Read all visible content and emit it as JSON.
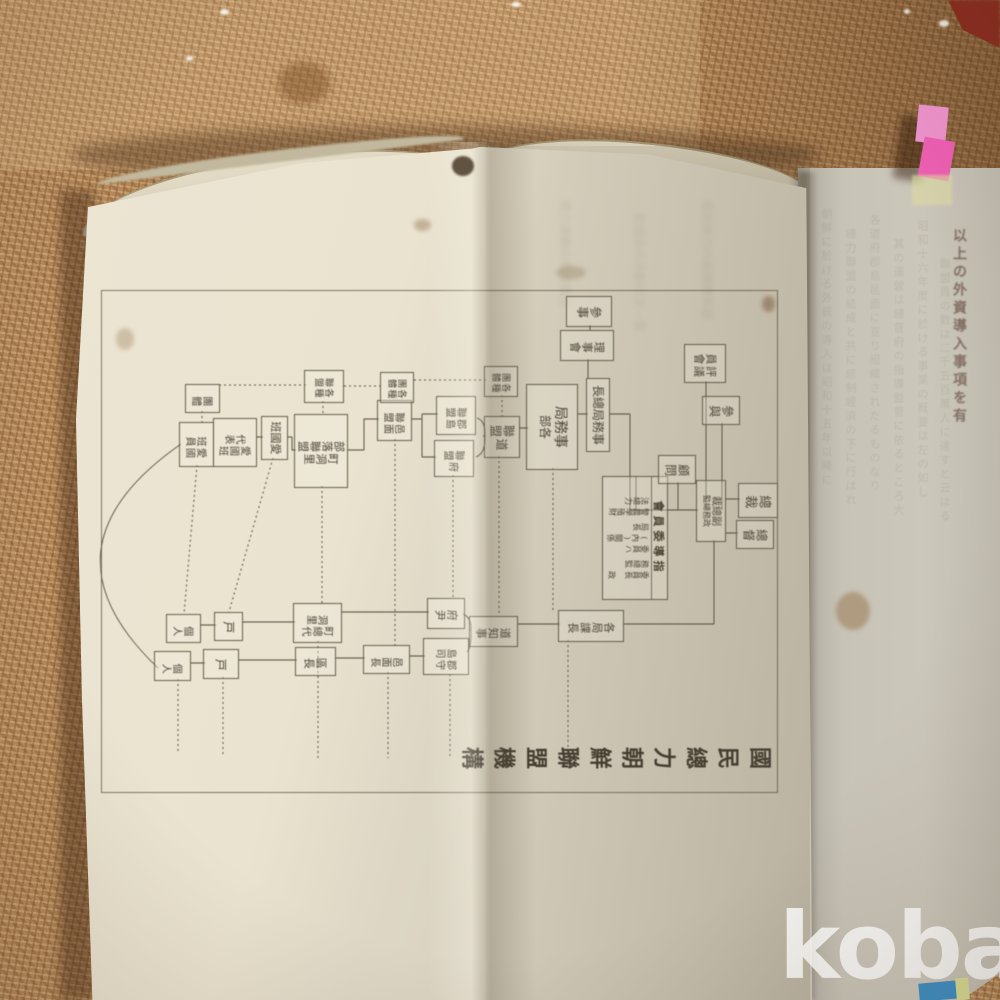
{
  "watermark": "kobay",
  "book": {
    "right_page_text": "以上の外資導入事項を有",
    "ghost_columns": [
      "朝鮮に於ける外資の導入は昭和十五年以降に",
      "總力聯盟の結成と共に統制經濟の下に行はれ",
      "各道府郡島邑面に亘り組織されたるものなり",
      "其の運營は總督府の指導監督に依るところ大",
      "昭和十六年度に於ける事業の概要は左の如し",
      "聯盟員の數は二千五百萬人に達すと云はる"
    ],
    "bleed_texts": [
      "總力運動の實踐要目",
      "愛國班の活動狀況一覽",
      "國民總力の組織體系圖"
    ]
  },
  "chart": {
    "title": "國民總力朝鮮聯盟機構",
    "committee": {
      "header": "指導委員會",
      "columns": [
        "委員長 政務總監",
        "委員ハ(內)關係局長",
        "警農學殖財法總力"
      ]
    },
    "boxes": [
      {
        "id": "sosai",
        "label": "總裁",
        "mode": "v",
        "x": 195,
        "y": 2,
        "w": 33,
        "h": 38,
        "fs": 13
      },
      {
        "id": "sotoku",
        "label": "總督",
        "mode": "v",
        "x": 232,
        "y": 6,
        "w": 27,
        "h": 36,
        "fs": 12
      },
      {
        "id": "fuku-sosai",
        "label": "副總裁",
        "label2": "政務總監",
        "mode": "h2",
        "x": 192,
        "y": 54,
        "w": 60,
        "h": 28,
        "fs": 10
      },
      {
        "id": "sanyo",
        "label": "參與",
        "mode": "v",
        "x": 108,
        "y": 40,
        "w": 27,
        "h": 36,
        "fs": 12
      },
      {
        "id": "hyogiin-kai",
        "label": "評議員會",
        "cols": [
          "評議",
          "員會"
        ],
        "mode": "cols",
        "x": 56,
        "y": 54,
        "w": 37,
        "h": 40,
        "fs": 11
      },
      {
        "id": "komon",
        "label": "顧問",
        "mode": "v",
        "x": 167,
        "y": 84,
        "w": 27,
        "h": 36,
        "fs": 12
      },
      {
        "id": "sanji",
        "label": "參事",
        "mode": "v",
        "x": 8,
        "y": 168,
        "w": 29,
        "h": 44,
        "fs": 12
      },
      {
        "id": "riji-kai",
        "label": "理事會",
        "mode": "v",
        "x": 42,
        "y": 166,
        "w": 29,
        "h": 52,
        "fs": 11
      },
      {
        "id": "jimukyoku-socho",
        "label": "事務局總長",
        "mode": "h",
        "x": 90,
        "y": 170,
        "w": 72,
        "h": 22,
        "fs": 12
      },
      {
        "id": "jimukyoku-kakubu",
        "label": "事務局",
        "label2": "各部",
        "mode": "h2",
        "x": 96,
        "y": 202,
        "w": 84,
        "h": 50,
        "fs": 14
      },
      {
        "id": "do-renmei",
        "label": "道聯盟",
        "cols": [
          "道",
          "聯盟"
        ],
        "mode": "cols",
        "x": 128,
        "y": 260,
        "w": 40,
        "h": 34,
        "fs": 12
      },
      {
        "id": "kakushu-dantai-1",
        "label": "各種團體",
        "cols": [
          "各種",
          "團體"
        ],
        "mode": "cols",
        "x": 78,
        "y": 262,
        "w": 29,
        "h": 32,
        "fs": 9
      },
      {
        "id": "gunto-renmei",
        "label": "郡島聯盟",
        "cols": [
          "郡島",
          "聯盟"
        ],
        "mode": "cols",
        "x": 108,
        "y": 304,
        "w": 37,
        "h": 38,
        "fs": 10
      },
      {
        "id": "fu-renmei",
        "label": "府聯盟",
        "cols": [
          "府",
          "聯盟"
        ],
        "mode": "cols",
        "x": 152,
        "y": 306,
        "w": 35,
        "h": 38,
        "fs": 10
      },
      {
        "id": "yumen-renmei",
        "label": "邑面聯盟",
        "cols": [
          "邑面",
          "聯盟"
        ],
        "mode": "cols",
        "x": 112,
        "y": 368,
        "w": 39,
        "h": 33,
        "fs": 10
      },
      {
        "id": "kakushu-dantai-2",
        "label": "各種團體",
        "cols": [
          "各種",
          "團體"
        ],
        "mode": "cols",
        "x": 84,
        "y": 366,
        "w": 29,
        "h": 32,
        "fs": 9
      },
      {
        "id": "cho-dori-buraku-renmei",
        "label": "町洞里部落聯盟",
        "cols": [
          "町洞里",
          "部落聯盟"
        ],
        "mode": "cols",
        "x": 126,
        "y": 432,
        "w": 72,
        "h": 52,
        "fs": 11
      },
      {
        "id": "kakushu-renmei",
        "label": "各種聯盟",
        "cols": [
          "各種",
          "聯盟"
        ],
        "mode": "cols",
        "x": 82,
        "y": 436,
        "w": 31,
        "h": 38,
        "fs": 9
      },
      {
        "id": "aikoku-han",
        "label": "愛國班",
        "mode": "h",
        "x": 128,
        "y": 492,
        "w": 42,
        "h": 25,
        "fs": 11
      },
      {
        "id": "aikoku-han-daihyo",
        "label": "愛國班代表",
        "cols": [
          "愛國班",
          "代表"
        ],
        "mode": "cols",
        "x": 130,
        "y": 523,
        "w": 47,
        "h": 42,
        "fs": 10
      },
      {
        "id": "aikoku-han-in",
        "label": "愛國班員",
        "cols": [
          "愛國",
          "班員"
        ],
        "mode": "cols",
        "x": 134,
        "y": 566,
        "w": 43,
        "h": 33,
        "fs": 10
      },
      {
        "id": "dantai",
        "label": "團體",
        "mode": "v",
        "x": 96,
        "y": 560,
        "w": 27,
        "h": 33,
        "fs": 10
      },
      {
        "id": "kakkyoku-kacho",
        "label": "各局課長",
        "mode": "v",
        "x": 322,
        "y": 156,
        "w": 30,
        "h": 64,
        "fs": 11
      },
      {
        "id": "do-chiji",
        "label": "道知事",
        "mode": "v",
        "x": 328,
        "y": 262,
        "w": 29,
        "h": 47,
        "fs": 11
      },
      {
        "id": "fuin",
        "label": "府尹",
        "mode": "v",
        "x": 310,
        "y": 315,
        "w": 29,
        "h": 36,
        "fs": 11
      },
      {
        "id": "gunshu-toshi",
        "label": "郡守島司",
        "cols": [
          "郡守",
          "島司"
        ],
        "mode": "cols",
        "x": 350,
        "y": 311,
        "w": 35,
        "h": 44,
        "fs": 10
      },
      {
        "id": "yumen-cho",
        "label": "邑面長",
        "mode": "v",
        "x": 357,
        "y": 370,
        "w": 27,
        "h": 45,
        "fs": 10
      },
      {
        "id": "cho-sodai-dori",
        "label": "町總代洞里",
        "cols": [
          "町總代",
          "洞里"
        ],
        "mode": "cols",
        "x": 315,
        "y": 438,
        "w": 38,
        "h": 47,
        "fs": 10
      },
      {
        "id": "kucho",
        "label": "區長",
        "mode": "v",
        "x": 359,
        "y": 444,
        "w": 27,
        "h": 39,
        "fs": 11
      },
      {
        "id": "ko-a",
        "label": "戸",
        "mode": "v",
        "x": 324,
        "y": 537,
        "w": 27,
        "h": 27,
        "fs": 12
      },
      {
        "id": "ko-b",
        "label": "戸",
        "mode": "v",
        "x": 361,
        "y": 541,
        "w": 28,
        "h": 34,
        "fs": 12
      },
      {
        "id": "kojin-a",
        "label": "個人",
        "mode": "v",
        "x": 326,
        "y": 579,
        "w": 27,
        "h": 33,
        "fs": 10
      },
      {
        "id": "kojin-b",
        "label": "個人",
        "mode": "v",
        "x": 363,
        "y": 589,
        "w": 28,
        "h": 35,
        "fs": 10
      }
    ]
  },
  "colors": {
    "tab_pink": "#ee5fb3",
    "tab_pink_light": "#ef93cd",
    "tab_yellow": "#dfdca2",
    "corner_blue": "#3f8fc4",
    "corner_yellow": "#d8dc96",
    "corner_red": "#8a2d20",
    "fabric": "#b5895a",
    "paper": "#eae3d0",
    "ink": "#4b4336"
  }
}
